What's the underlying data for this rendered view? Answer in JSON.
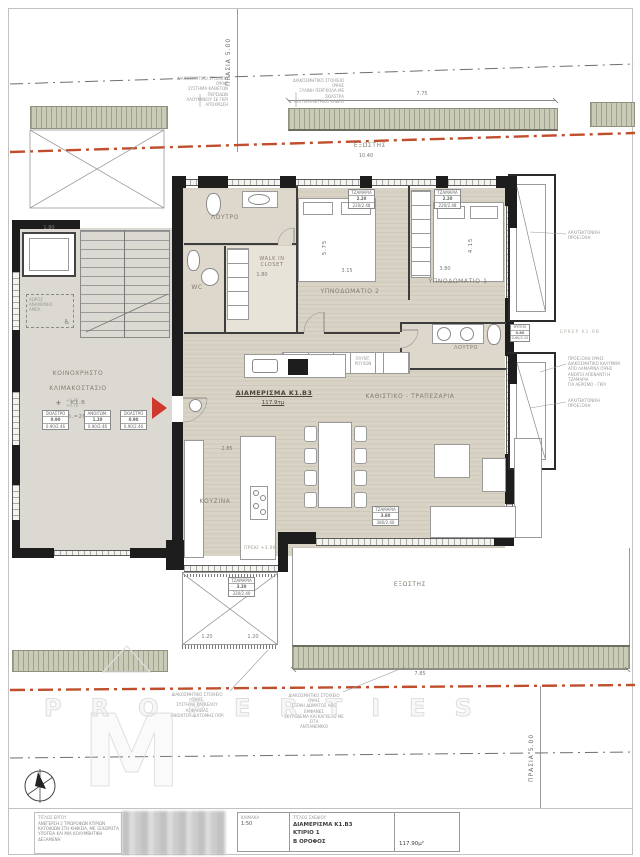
{
  "labels": {
    "prasia_top": "ΠΡΑΣΙΑ 5.00",
    "prasia_bottom": "ΠΡΑΣΙΑ 5.00",
    "balcony_top": "ΕΞΩΣΤΗΣ",
    "balcony_bottom": "ΕΞΩΣΤΗΣ",
    "erker": "ΕΡΚΕΡ Κ1.0Β",
    "preki": "ΠΡΕΚΙ +3.06",
    "apartment_title": "ΔΙΑΜΕΡΙΣΜΑ Κ1.Β3",
    "apartment_area": "117.9τμ"
  },
  "rooms": {
    "bath1": "ΛΟΥΤΡΟ",
    "walkin": "WALK IN\nCLOSET",
    "wc": "WC",
    "bedroom2": "ΥΠΝΟΔΩΜΑΤΙΟ 2",
    "bedroom1": "ΥΠΝΟΔΩΜΑΤΙΟ 1",
    "bath2": "ΛΟΥΤΡΟ",
    "living": "ΚΑΘΙΣΤΙΚΟ - ΤΡΑΠΕΖΑΡΙΑ",
    "kitchen": "ΚΟΥΖΙΝΑ"
  },
  "stair": {
    "l1": "ΚΟΙΝΟΧΡΗΣΤΟ",
    "l2": "ΚΛΙΜΑΚΟΣΤΑΣΙΟ",
    "l3": "Κ1.Β",
    "l4": "Εμβαδ.=26.66τμ",
    "levels": "+6.45\n+6.70",
    "amea": "ΧΩΡΟΣ\nΑΝΑΜΟΝΗΣ\nΑΜΕΑ",
    "amea_icon": "♿"
  },
  "laundry": "ΠΛΥΝΤ.\nΡΟΥΧΩΝ",
  "dims": {
    "top_width": "7.75",
    "top_length": "10.40",
    "bottom_width": "7.85",
    "pergola_a": "1.20",
    "pergola_b": "1.20",
    "kitchen_w": "2.85",
    "bed2_w": "3.15",
    "bed2_h": "5.75",
    "bed1_w": "3.80",
    "bed1_h": "4.15",
    "lift_w": "1.80",
    "closet_w": "1.80"
  },
  "window_tags": [
    {
      "name": "ΣΚΙΑΣΤΡΟ",
      "size": "0.90",
      "spec": "0.90/2.46"
    },
    {
      "name": "ΑΝΟΙΓΩΜ.",
      "size": "1.20",
      "spec": "0.90/2.46"
    },
    {
      "name": "ΣΚΙΑΣΤΡΟ",
      "size": "0.90",
      "spec": "0.90/2.46"
    },
    {
      "name": "ΤΖΑΜΑΡΙΑ",
      "size": "2.20",
      "spec": "220/2.48"
    },
    {
      "name": "ΤΖΑΜΑΡΙΑ",
      "size": "2.20",
      "spec": "220/2.48"
    },
    {
      "name": "ΤΖΑΜΑΡΙΑ",
      "size": "3.80",
      "spec": "380/2.40"
    },
    {
      "name": "ΤΖΑΜΑΡΙΑ",
      "size": "3.20",
      "spec": "320/2.40"
    },
    {
      "name": "ΨΥΓΕΙΟ",
      "size": "0.60",
      "spec": "0.60/2.10"
    }
  ],
  "notes": {
    "top1": "ΔΙΑΚΟΣΜΗΤΙΚΟ ΣΤΟΙΧΕΙΟ ΟΨΗΣ\nΣΥΣΤΗΜΑ ΚΑΘΕΤΩΝ ΠΕΡΣΙΔΩΝ\nΑΛΟΥΜΙΝΙΟΥ ΣΕ ΓΚΡΙ\nΑΠΟΧΡΩΣΗ",
    "top2": "ΔΙΑΚΟΣΜΗΤΙΚΟ ΣΤΟΙΧΕΙΟ ΟΨΗΣ\nΞΥΛΙΝΗ ΠΕΡΓΚΟΛΑ ΜΕ ΣΚΙΑΣΤΡΑ\nΚΑΙ ΠΕΡΙΜΕΤΡΙΚΟ ΚΑΔΡΟ",
    "bottom1": "ΔΙΑΚΟΣΜΗΤΙΚΟ ΣΤΟΙΧΕΙΟ ΟΨΗΣ\nΣΥΣΤΗΜΑ ΚΑΓΚΕΛΟΥ ΑΣΦΑΛΕΙΑΣ\nΑΝΟΙΧΤΟΥ ΔΙΑΤΟΜΗΣ ΓΚΡΙ",
    "bottom2": "ΔΙΑΚΟΣΜΗΤΙΚΟ ΣΤΟΙΧΕΙΟ ΟΨΗΣ\nΣΤΕΨΗ ΔΩΜΑΤΟΣ ΑΠΟ ΕΜΦΑΝΕΣ\nΣΚΥΡΟΔΕΜΑ ΚΑΙ ΚΑΓΚΕΛΟ ΜΕ ΣΙΤΑ\nΑΝΤΙΑΝΕΜΙΚΟ",
    "erker1": "ΑΡΧΙΤΕΚΤΟΝΙΚΗ\nΠΡΟΕΞΟΧΗ",
    "erker2": "ΠΡΟΕΞΟΧΗ ΟΨΗΣ\nΔΙΑΚΟΣΜΗΤΙΚΟ ΚΑΛΥΜΜΑ\nΑΠΟ ΛΑΜΑΡΙΝΑ ΟΨΗΣ\nΑΝΟΙΓΕΙ ΑΠΕΝΑΝΤΙ Η ΤΖΑΜΑΡΙΑ\nΓΙΑ ΑΕΡΙΣΜΟ - ΓΚΡΙ",
    "erker3": "ΑΡΧΙΤΕΚΤΟΝΙΚΗ\nΠΡΟΕΞΟΧΗ"
  },
  "watermark": {
    "word": "PROPERTIES",
    "letter": "M"
  },
  "titleblock": {
    "project_label": "ΤΙΤΛΟΣ ΕΡΓΟΥ",
    "project": "ΑΝΕΓΕΡΣΗ 2 ΤΡΙΩΡΟΦΩΝ ΚΤΙΡΙΩΝ\nΚΑΤΟΙΚΙΩΝ ΣΤΗ ΚΗΦΙΣΙΑ, ΜΕ ΞΕΧΩΡΙΣΤΑ\nΥΠΟΓΕΙΑ ΚΑΙ ΜΙΑ ΚΟΛΥΜΒΗΤΙΚΗ\nΔΕΞΑΜΕΝΗ",
    "scale_label": "ΚΛΙΜΑΚΑ",
    "scale": "1:50",
    "drawing_label": "ΤΙΤΛΟΣ ΣΧΕΔΙΟΥ",
    "drawing1": "ΔΙΑΜΕΡΙΣΜΑ Κ1.Β3",
    "drawing2": "ΚΤΙΡΙΟ 1",
    "drawing3": "Β ΟΡΟΦΟΣ",
    "area": "117.90μ²"
  }
}
